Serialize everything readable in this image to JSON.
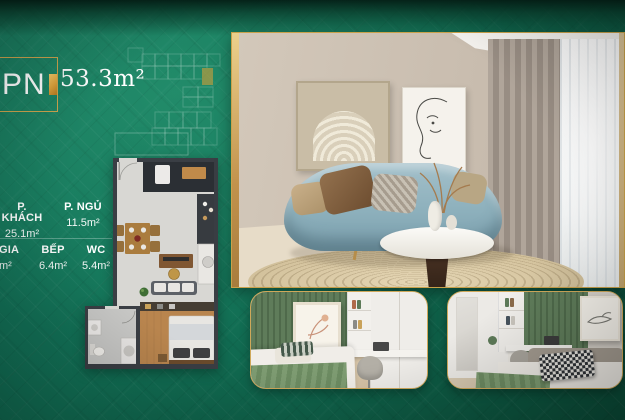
{
  "badge": {
    "unit_type": "PN",
    "area": "53.3m²"
  },
  "rooms": [
    {
      "name": "P. KHÁCH",
      "area": "25.1m²"
    },
    {
      "name": "P. NGỦ",
      "area": "11.5m²"
    },
    {
      "name": "GIA",
      "area": "m²"
    },
    {
      "name": "BẾP",
      "area": "6.4m²"
    },
    {
      "name": "WC",
      "area": "5.4m²"
    }
  ],
  "colors": {
    "background_green": "#14735a",
    "background_green_dark": "#0a4634",
    "accent_gold": "#d9a23f",
    "text": "#ffffff"
  }
}
